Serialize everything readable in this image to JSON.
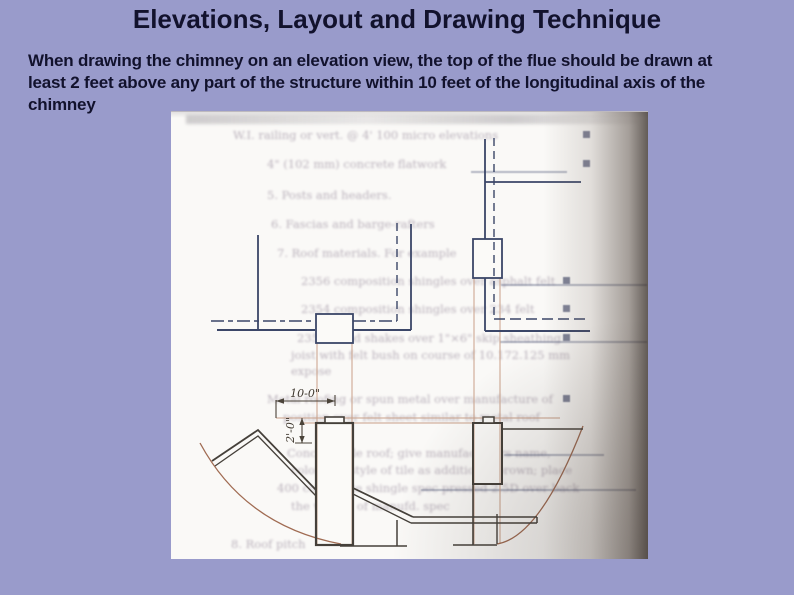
{
  "slide": {
    "title": "Elevations, Layout and Drawing Technique",
    "body_lines": [
      "When drawing the chimney on an elevation view, the top of the flue should be drawn at",
      "least 2 feet above any part of the structure within 10 feet of the longitudinal axis of the",
      "chimney"
    ],
    "colors": {
      "background": "#999bcb",
      "text": "#12122d"
    }
  },
  "figure": {
    "dimensions": {
      "horizontal": "10-0\"",
      "vertical": "2'-0\""
    },
    "colors": {
      "ink_blue": "#3b4668",
      "ink_dark": "#45403a",
      "arc": "#a06b52",
      "projection_line": "#c9a089",
      "page": "#faf9f7"
    },
    "bleedthrough": {
      "lines": [
        {
          "x": 62,
          "y": 16,
          "t": "W.I. railing or vert. @ 4' 100 micro elevations",
          "bx": 412
        },
        {
          "x": 96,
          "y": 45,
          "t": "4\" (102 mm) concrete flatwork",
          "bx": 412
        },
        {
          "x": 96,
          "y": 76,
          "t": "5. Posts and headers."
        },
        {
          "x": 100,
          "y": 105,
          "t": "6. Fascias and barge-rafters"
        },
        {
          "x": 106,
          "y": 134,
          "t": "7. Roof materials. For example"
        },
        {
          "x": 130,
          "y": 162,
          "t": "2356 composition shingles over asphalt felt",
          "bx": 392
        },
        {
          "x": 130,
          "y": 190,
          "t": "2354 composition shingles over 234 felt",
          "bx": 392
        },
        {
          "x": 126,
          "y": 219,
          "t": "2352 wood shakes over 1\"×6\" skip sheathing",
          "bx": 392
        },
        {
          "x": 120,
          "y": 236,
          "t": "joist with felt bush on course of 10.172.125 mm"
        },
        {
          "x": 120,
          "y": 252,
          "t": "expose"
        },
        {
          "x": 96,
          "y": 280,
          "t": "Metal roofing or spun metal over manufacture of",
          "bx": 392
        },
        {
          "x": 112,
          "y": 298,
          "t": "position over felt sheet similar to metal roof"
        },
        {
          "x": 116,
          "y": 334,
          "t": "Concrete tile roof; give manufacturers name,"
        },
        {
          "x": 120,
          "y": 351,
          "t": "color and style of tile as additional brown; place"
        },
        {
          "x": 106,
          "y": 369,
          "t": "400 composite shingle spec pressed 2.5D over back"
        },
        {
          "x": 120,
          "y": 387,
          "t": "the weight of manufd. spec"
        },
        {
          "x": 60,
          "y": 425,
          "t": "8. Roof pitch"
        }
      ],
      "underlines": [
        {
          "x": 300,
          "y": 59,
          "w": 96
        },
        {
          "x": 330,
          "y": 172,
          "w": 146
        },
        {
          "x": 329,
          "y": 229,
          "w": 147
        },
        {
          "x": 333,
          "y": 342,
          "w": 100
        },
        {
          "x": 250,
          "y": 377,
          "w": 215
        }
      ]
    }
  }
}
